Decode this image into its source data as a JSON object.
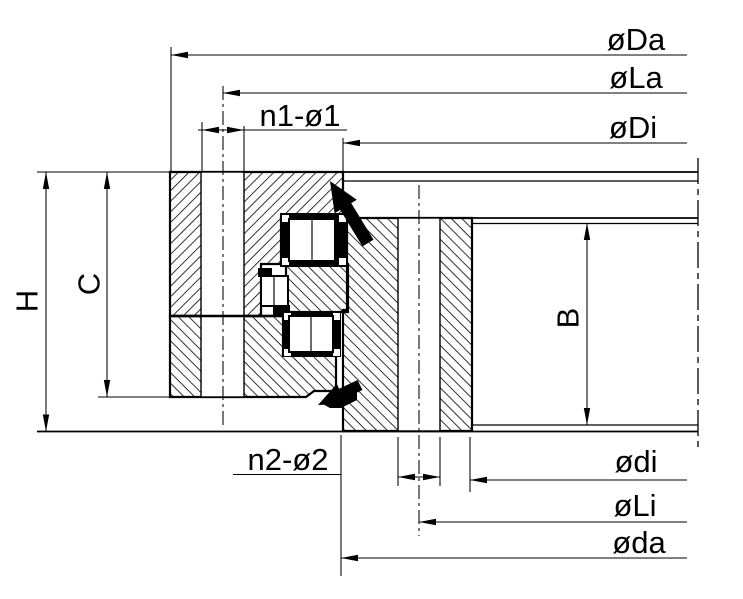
{
  "drawing": {
    "component": "three-row roller slewing bearing cross-section",
    "colors": {
      "ink": "#000000",
      "paper": "#ffffff"
    },
    "labels": {
      "outer_diameter": "øDa",
      "outer_bolt_circle": "øLa",
      "outer_ring_inner_diameter": "øDi",
      "outer_ring_bolt_holes": "n1-ø1",
      "inner_ring_bolt_holes": "n2-ø2",
      "inner_bore_diameter": "ødi",
      "inner_bolt_circle": "øLi",
      "inner_ring_outer_diameter": "øda",
      "total_height": "H",
      "outer_ring_height": "C",
      "inner_ring_height": "B"
    }
  }
}
